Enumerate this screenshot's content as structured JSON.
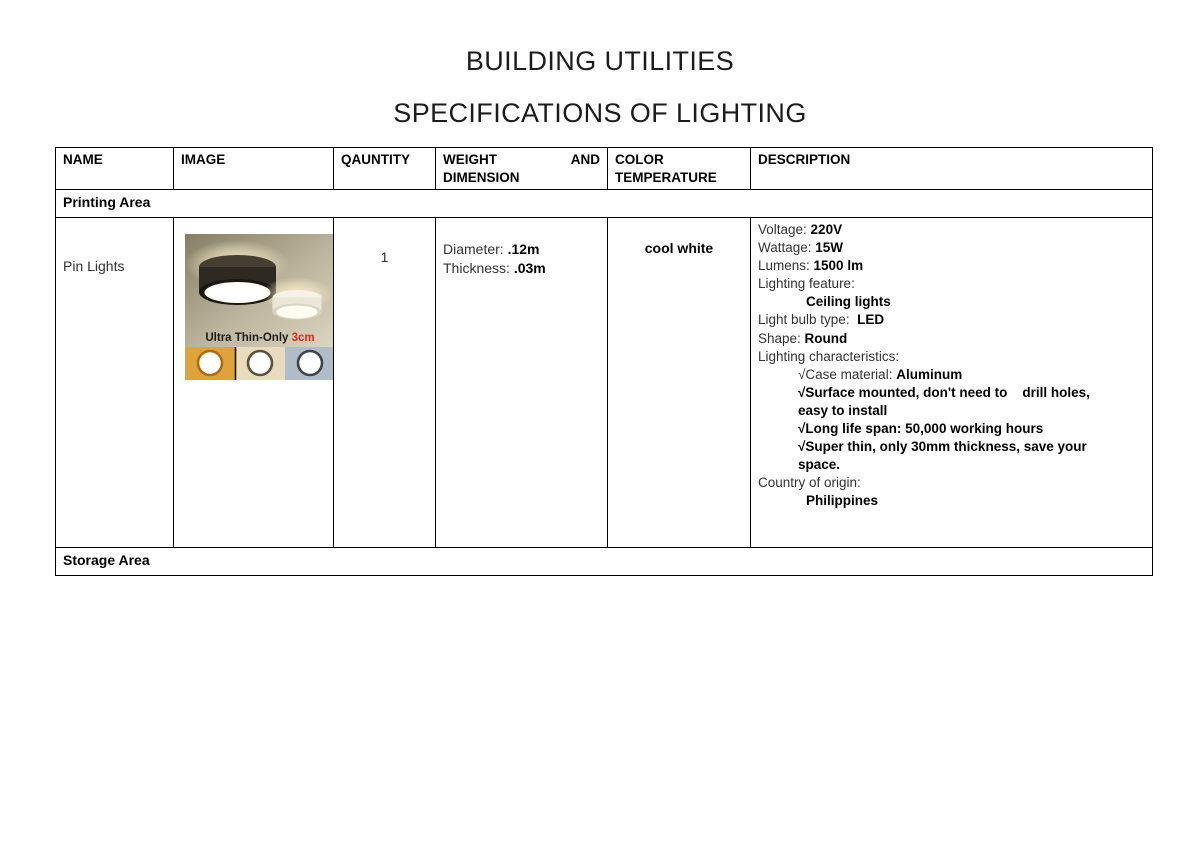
{
  "document": {
    "title": "BUILDING UTILITIES",
    "subtitle": "SPECIFICATIONS OF LIGHTING"
  },
  "table": {
    "headers": [
      "NAME",
      "IMAGE",
      "QAUNTITY",
      "WEIGHT AND DIMENSION",
      "COLOR TEMPERATURE",
      "DESCRIPTION"
    ],
    "section_rows": {
      "printing": "Printing Area",
      "storage": "Storage Area"
    },
    "product": {
      "name": "Pin Lights",
      "quantity": "1",
      "dimensions": [
        {
          "label": "Diameter: ",
          "value": ".12m"
        },
        {
          "label": "Thickness: ",
          "value": ".03m"
        }
      ],
      "color_temperature": "cool white",
      "description": [
        {
          "label": "Voltage: ",
          "value": "220V",
          "indent": 0
        },
        {
          "label": "Wattage: ",
          "value": "15W",
          "indent": 0
        },
        {
          "label": "Lumens: ",
          "value": "1500 lm",
          "indent": 0
        },
        {
          "label": "Lighting feature:",
          "value": "",
          "indent": 0
        },
        {
          "label": "",
          "value": "Ceiling lights",
          "indent": 2
        },
        {
          "label": "Light bulb type:  ",
          "value": "LED",
          "indent": 0
        },
        {
          "label": "Shape: ",
          "value": "Round",
          "indent": 0
        },
        {
          "label": "Lighting characteristics:",
          "value": "",
          "indent": 0
        },
        {
          "label": "√Case material: ",
          "value": "Aluminum",
          "indent": 1
        },
        {
          "label": "",
          "value": "√Surface mounted, don't need to    drill holes,\neasy to install",
          "indent": 1
        },
        {
          "label": "",
          "value": "√Long life span: 50,000 working hours",
          "indent": 1
        },
        {
          "label": "",
          "value": "√Super thin, only 30mm thickness, save your\nspace.",
          "indent": 1
        },
        {
          "label": "Country of origin:",
          "value": "",
          "indent": 0
        },
        {
          "label": "",
          "value": "Philippines",
          "indent": 2
        }
      ],
      "image": {
        "caption_text": "Ultra Thin-Only ",
        "caption_highlight": "3cm",
        "caption_text_color": "#1c1c1c",
        "caption_highlight_color": "#e3281e",
        "swatches": [
          {
            "name": "warm-white",
            "bg": "#dfa33e",
            "rim": "#b5690f"
          },
          {
            "name": "natural-white",
            "bg": "#e7dcbd",
            "rim": "#5e5138"
          },
          {
            "name": "cool-white",
            "bg": "#b0bdc8",
            "rim": "#3e444c"
          }
        ]
      }
    }
  }
}
